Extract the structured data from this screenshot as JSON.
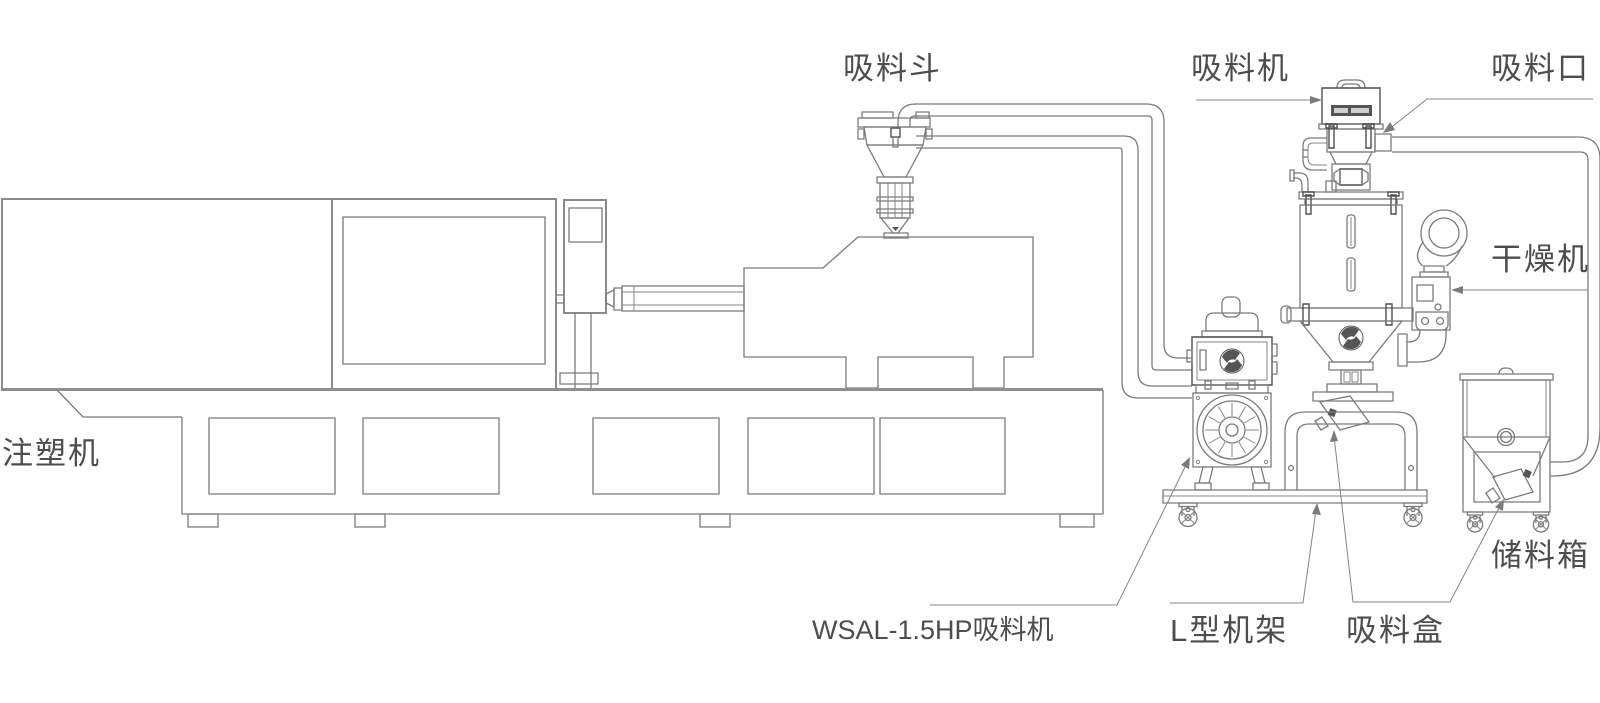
{
  "diagram": {
    "kind": "injection-molding-auto-feeding-system",
    "background_color": "#ffffff",
    "line_color": "#7b7b7b",
    "label_color": "#4d4d4d",
    "labels": {
      "suction_hopper": "吸料斗",
      "vacuum_loader": "吸料机",
      "suction_inlet": "吸料口",
      "dryer": "干燥机",
      "injection_machine": "注塑机",
      "wsal_pump": "WSAL-1.5HP吸料机",
      "l_frame": "L型机架",
      "suction_box": "吸料盒",
      "storage_box": "储料箱"
    }
  }
}
